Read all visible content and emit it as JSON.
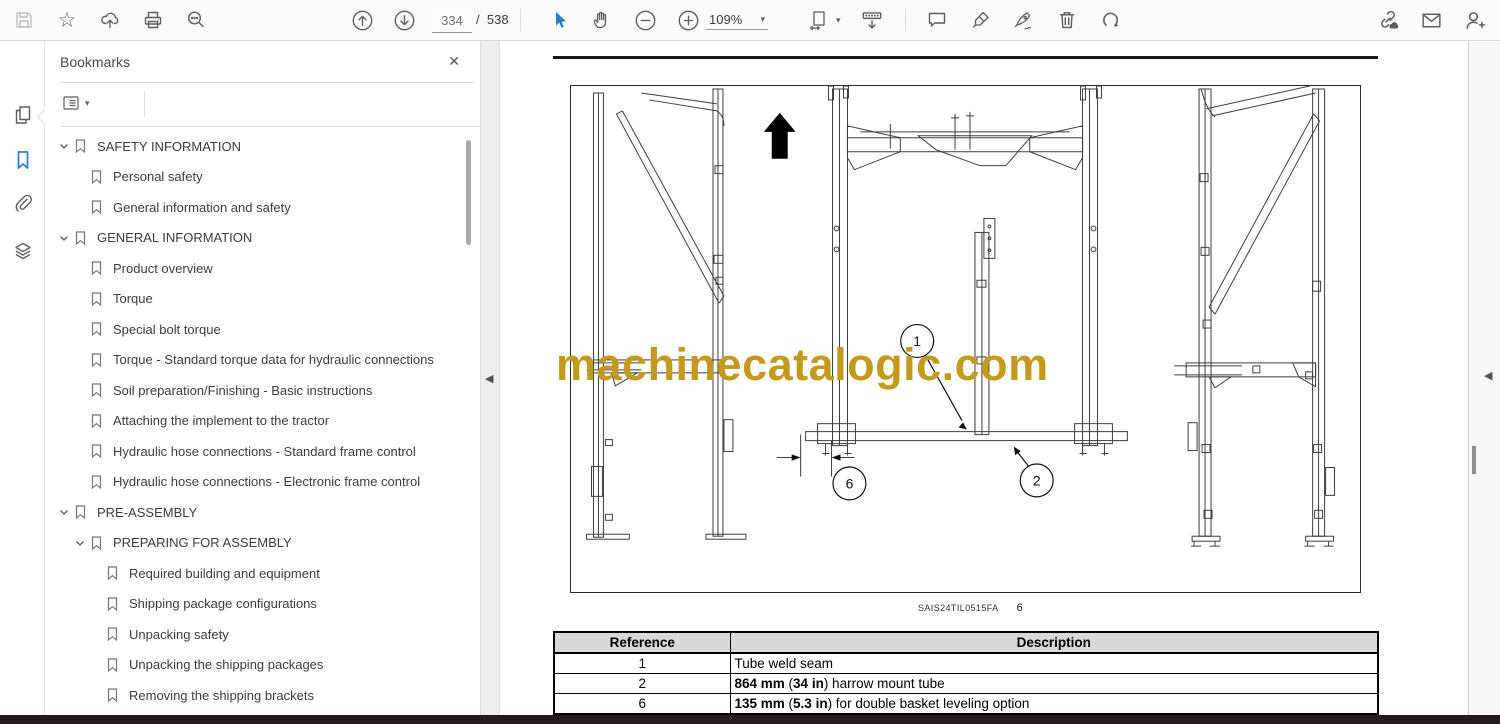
{
  "toolbar": {
    "page_current": "334",
    "page_separator": "/",
    "page_total": "538",
    "zoom_level": "109%"
  },
  "icons": {
    "star": "☆",
    "close": "✕",
    "caret": "▾",
    "collapse_left": "◀"
  },
  "panel": {
    "title": "Bookmarks"
  },
  "bookmarks": {
    "items": [
      {
        "level": 0,
        "expandable": true,
        "label": "SAFETY INFORMATION"
      },
      {
        "level": 1,
        "expandable": false,
        "label": "Personal safety"
      },
      {
        "level": 1,
        "expandable": false,
        "label": "General information and safety"
      },
      {
        "level": 0,
        "expandable": true,
        "label": "GENERAL INFORMATION"
      },
      {
        "level": 1,
        "expandable": false,
        "label": "Product overview"
      },
      {
        "level": 1,
        "expandable": false,
        "label": "Torque"
      },
      {
        "level": 1,
        "expandable": false,
        "label": "Special bolt torque"
      },
      {
        "level": 1,
        "expandable": false,
        "label": "Torque - Standard torque data for hydraulic connections"
      },
      {
        "level": 1,
        "expandable": false,
        "label": "Soil preparation/Finishing - Basic instructions"
      },
      {
        "level": 1,
        "expandable": false,
        "label": "Attaching the implement to the tractor"
      },
      {
        "level": 1,
        "expandable": false,
        "label": "Hydraulic hose connections - Standard frame control"
      },
      {
        "level": 1,
        "expandable": false,
        "label": "Hydraulic hose connections - Electronic frame control"
      },
      {
        "level": 0,
        "expandable": true,
        "label": "PRE-ASSEMBLY"
      },
      {
        "level": 1,
        "expandable": true,
        "label": "PREPARING FOR ASSEMBLY"
      },
      {
        "level": 2,
        "expandable": false,
        "label": "Required building and equipment"
      },
      {
        "level": 2,
        "expandable": false,
        "label": "Shipping package configurations"
      },
      {
        "level": 2,
        "expandable": false,
        "label": "Unpacking safety"
      },
      {
        "level": 2,
        "expandable": false,
        "label": "Unpacking the shipping packages"
      },
      {
        "level": 2,
        "expandable": false,
        "label": "Removing the shipping brackets"
      }
    ]
  },
  "document": {
    "figure": {
      "watermark": "machinecatalogic.com",
      "caption_code": "SAIS24TIL0515FA",
      "caption_number": "6",
      "callouts": [
        {
          "label": "1"
        },
        {
          "label": "2"
        },
        {
          "label": "6"
        }
      ]
    },
    "table": {
      "headers": [
        "Reference",
        "Description"
      ],
      "rows": [
        {
          "reference": "1",
          "description": [
            {
              "text": "Tube weld seam",
              "bold": false
            }
          ]
        },
        {
          "reference": "2",
          "description": [
            {
              "text": "864 mm",
              "bold": true
            },
            {
              "text": " (",
              "bold": false
            },
            {
              "text": "34 in",
              "bold": true
            },
            {
              "text": ") harrow mount tube",
              "bold": false
            }
          ]
        },
        {
          "reference": "6",
          "description": [
            {
              "text": "135 mm",
              "bold": true
            },
            {
              "text": " (",
              "bold": false
            },
            {
              "text": "5.3 in",
              "bold": true
            },
            {
              "text": ") for double basket leveling option",
              "bold": false
            }
          ]
        }
      ]
    }
  },
  "colors": {
    "accent_blue": "#1f7ed6",
    "watermark_gold": "#c49a1c",
    "table_header_bg": "#d8d8d8"
  }
}
